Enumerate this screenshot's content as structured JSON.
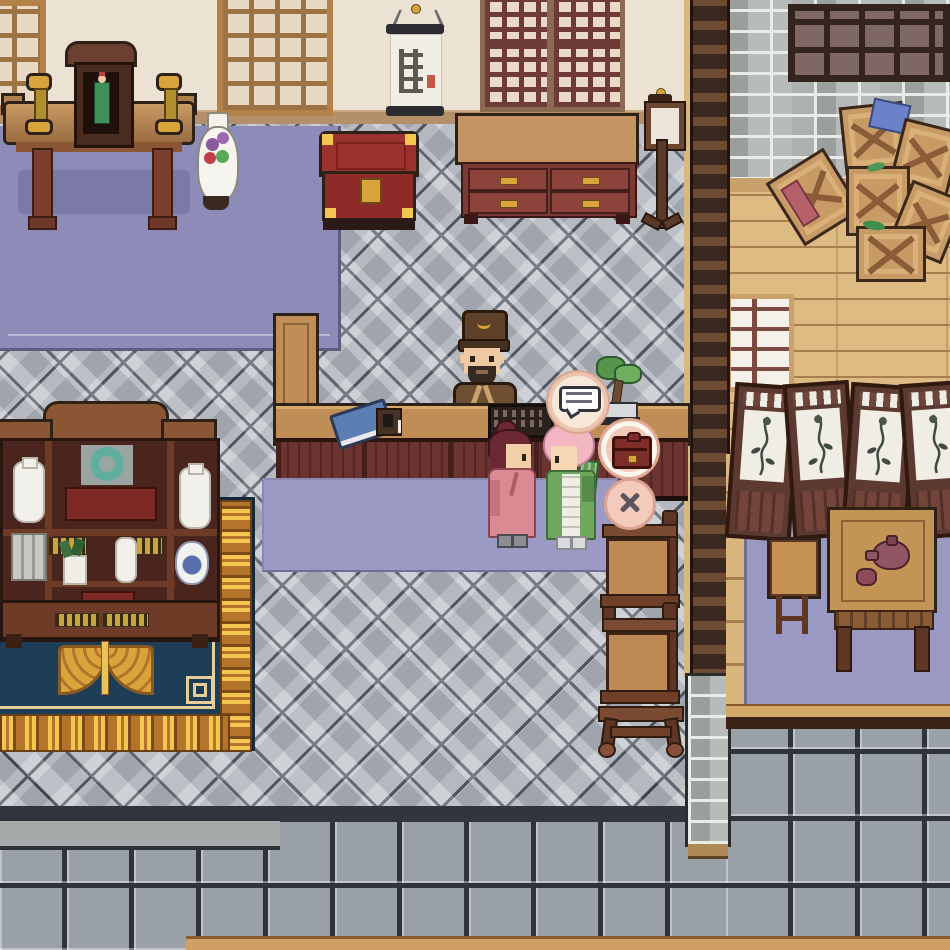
{
  "meta": {
    "type": "game-screenshot",
    "genre": "top-down pixel-art RPG shop interior",
    "description": "Chinese-style shop: shopkeeper NPC behind an L-shaped counter talks with two customers; dialogue and shop UI buttons float beside the counter."
  },
  "hud": {
    "dialogue_indicator": {
      "icon": "speech-bubble-icon",
      "style": "white bubble with text dashes in cream circle"
    },
    "shop_button": {
      "icon": "satchel-bag-icon",
      "style": "dark-red satchel in pink circle"
    },
    "close_button": {
      "icon": "x-close-icon",
      "style": "dark X in pink circle"
    }
  },
  "npcs": [
    {
      "id": "shopkeeper",
      "look": "brown hat with gold crest, dark beard, brown robe",
      "position": "behind counter"
    },
    {
      "id": "customer-red-hair",
      "look": "maroon bun hair, rose-pink robe",
      "position": "front of counter, facing right"
    },
    {
      "id": "customer-pink-hair",
      "look": "pink fluffy hair, green dress with white apron, carrying leek bundle",
      "position": "front of counter, facing left"
    }
  ],
  "props": [
    "altar-table with shrine cabinet, deity statue and two gold candlesticks",
    "porcelain flower vase",
    "hanging calligraphy scroll with red seal",
    "tan lattice window",
    "two maroon lattice windows",
    "red chest with gold fittings",
    "maroon sideboard with four drawers",
    "standing paper lamp",
    "L-shaped wooden counter with blue book, plaque, abacus and bonsai",
    "curio display cabinet with jade disc, vases, blue-white jar, scrolls, plant, red boxes",
    "navy carpet with gold meander border and gold pendant ornament",
    "stacked wooden chairs",
    "ladder pillar room divider",
    "gray brick wall with dark mullioned window",
    "pile of wooden crates with red and blue cloth",
    "shoji lattice door",
    "four-panel folding screen with plant paintings",
    "side chair",
    "tea table with plum teapot and cup",
    "lavender rugs"
  ],
  "floors": [
    "diamond gray tiles",
    "purple floor mat",
    "lavender rugs",
    "wood planks",
    "square gray tiles",
    "stone step threshold"
  ],
  "palette": {
    "wall": "#ece2d4",
    "baseboard": "#b3906a",
    "outline": "#2e2118",
    "purple-floor": "#8d8cb8",
    "purple-shadow": "#7b7aa6",
    "rug": "#9b9ac4",
    "rug-edge": "#6f6e94",
    "tile": "#b7bbc2",
    "tile-line": "#333a46",
    "sqtile": "#9aa0a7",
    "sqline": "#2f333b",
    "brick": "#b7bbb9",
    "mortar": "#e9ebe9",
    "plank": "#ddbb82",
    "plank-line": "#a67e50",
    "wood": "#bf8d55",
    "wood-dark": "#8a5f38",
    "maroon": "#6b3431",
    "maroon-dark": "#451f1c",
    "crimson": "#96302c",
    "navy": "#1e3d57",
    "gold": "#d9a43b",
    "gold-bright": "#f3c64f",
    "frame": "#5d3a31",
    "paper": "#f0ede4",
    "skin": "#eec9a1",
    "robe-brown": "#6f4f33",
    "pink": "#d98a92",
    "hair-red": "#6b2a33",
    "hair-pink": "#f2b7c3",
    "green": "#6fa75f",
    "apron": "#efeee6",
    "btn-pink": "#f2c8b8",
    "satchel": "#7e2d28",
    "teal": "#5fae9e",
    "blue": "#5b7fb5",
    "lantern-wood": "#6b4630"
  }
}
